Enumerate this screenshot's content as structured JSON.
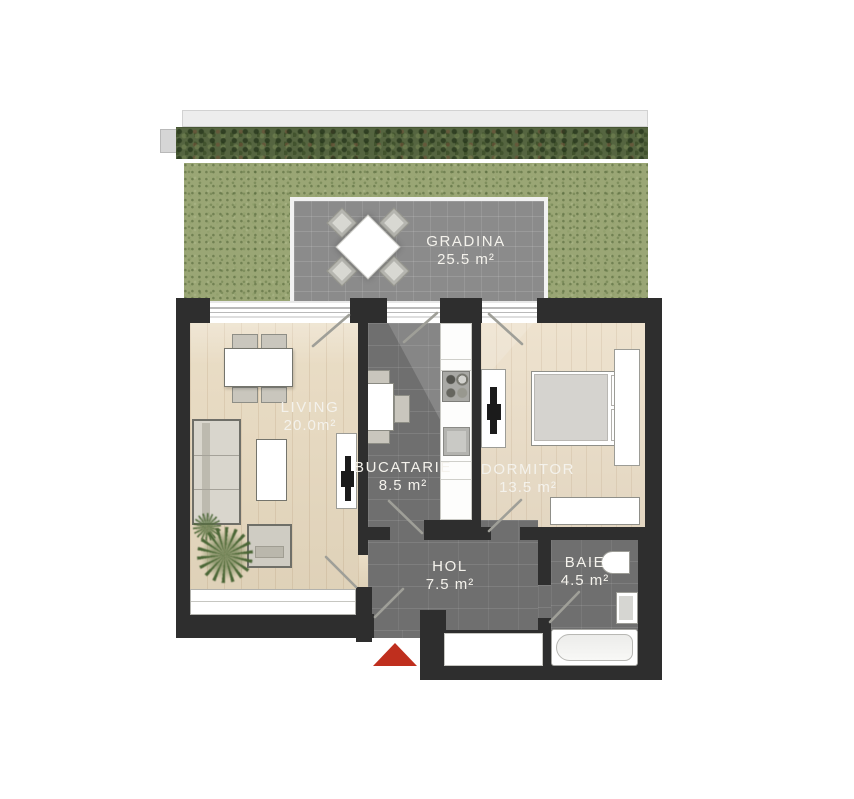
{
  "rooms": {
    "gradina": {
      "label": "GRADINA",
      "area": "25.5 m²"
    },
    "living": {
      "label": "LIVING",
      "area": "20.0m²"
    },
    "bucatarie": {
      "label": "BUCATARIE",
      "area": "8.5 m²"
    },
    "dormitor": {
      "label": "DORMITOR",
      "area": "13.5 m²"
    },
    "hol": {
      "label": "HOL",
      "area": "7.5 m²"
    },
    "baie": {
      "label": "BAIE",
      "area": "4.5 m²"
    }
  },
  "colors": {
    "wall": "#2e2e2e",
    "tile_floor": "#6f6f6f",
    "terrace": "#8b8b8b",
    "wood_floor": "#e8dac0",
    "grass": "#9aa675",
    "entrance_arrow": "#bf2f1e",
    "label_text": "#f4f2ec"
  }
}
